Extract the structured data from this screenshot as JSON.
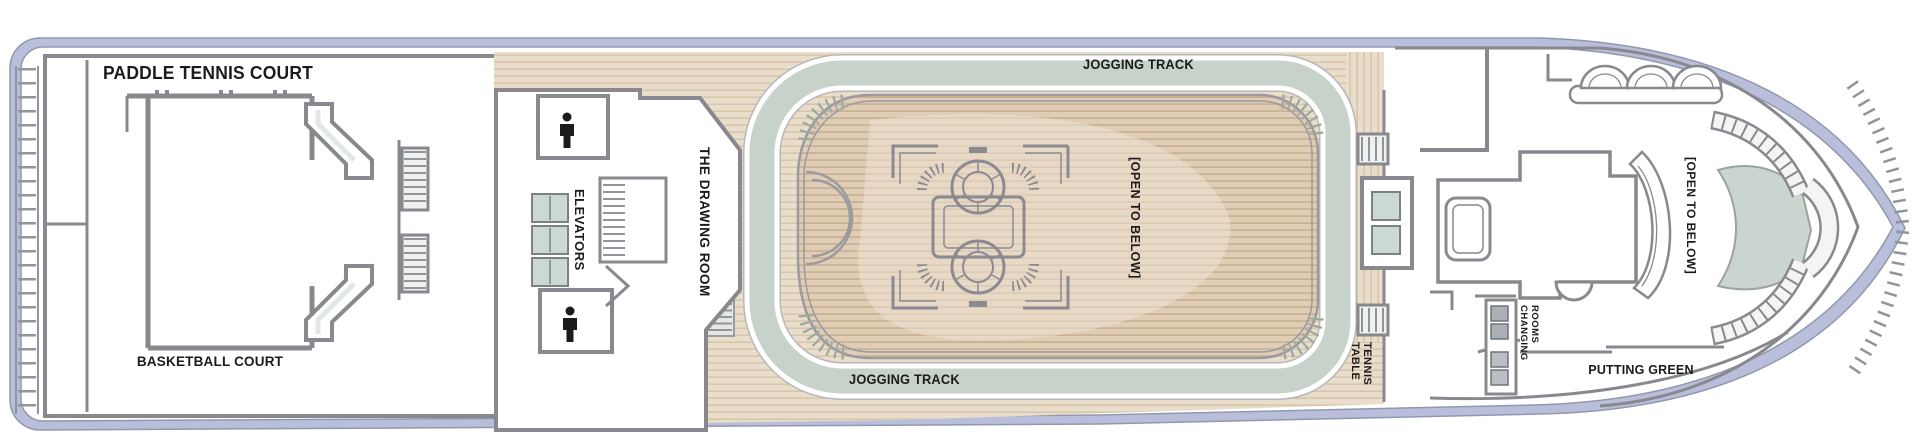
{
  "document": {
    "type": "cruise-ship-deck-plan",
    "orientation": "bow-right"
  },
  "labels": {
    "aft_court_top": "PADDLE TENNIS COURT",
    "aft_court_bottom": "BASKETBALL COURT",
    "elevators": "ELEVATORS",
    "drawing_room": "THE DRAWING ROOM",
    "jogging_track_top": "JOGGING TRACK",
    "jogging_track_bottom": "JOGGING TRACK",
    "open_to_below_atrium": "[OPEN TO BELOW]",
    "open_to_below_bow": "[OPEN TO BELOW]",
    "table_tennis_line1": "TABLE",
    "table_tennis_line2": "TENNIS",
    "changing_line1": "CHANGING",
    "changing_line2": "ROOMS",
    "putting_green": "PUTTING GREEN"
  },
  "icons": [
    {
      "name": "mens-restroom-icon",
      "location": "midship-top"
    },
    {
      "name": "mens-restroom-icon",
      "location": "midship-bottom"
    }
  ],
  "colors": {
    "hull_band": "#b9bfdb",
    "hull_edge": "#9198ad",
    "wall_gray": "#88888e",
    "rail_gray": "#9a9aa0",
    "deck_wood": "#e9decb",
    "deck_plank_line": "#d8c5aa",
    "atrium_wood": "#dfcdb6",
    "atrium_plank_line": "#cbb295",
    "atrium_highlight": "#f0e6d6",
    "track_sage": "#c7d3ca",
    "fixture_sage": "#ccd8d2",
    "locker_gray": "#aab0b6",
    "hatch_gray": "#8f959b",
    "text": "#1b1b1b"
  }
}
